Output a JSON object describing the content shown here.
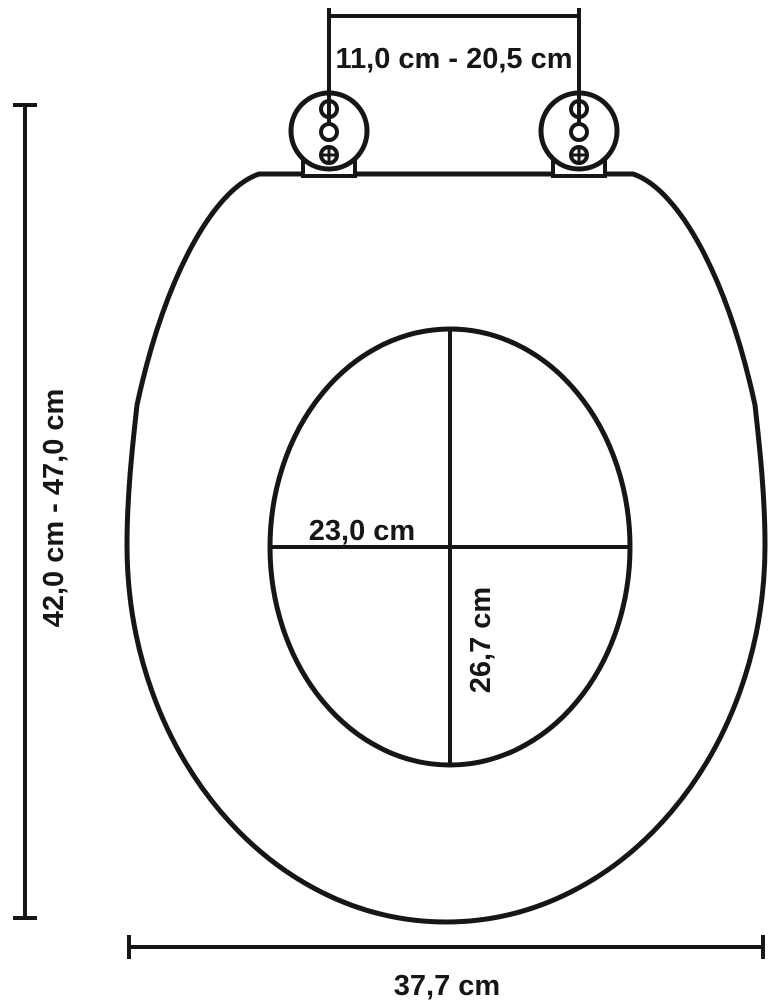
{
  "diagram": {
    "description": "Technical dimension drawing of an oval toilet seat with two hinges",
    "colors": {
      "background": "#ffffff",
      "line": "#161616",
      "text": "#161616"
    },
    "labels": {
      "hinge_spacing": "11,0 cm - 20,5 cm",
      "seat_length_range": "42,0 cm - 47,0 cm",
      "opening_width": "23,0 cm",
      "opening_depth": "26,7 cm",
      "seat_width": "37,7 cm"
    }
  }
}
